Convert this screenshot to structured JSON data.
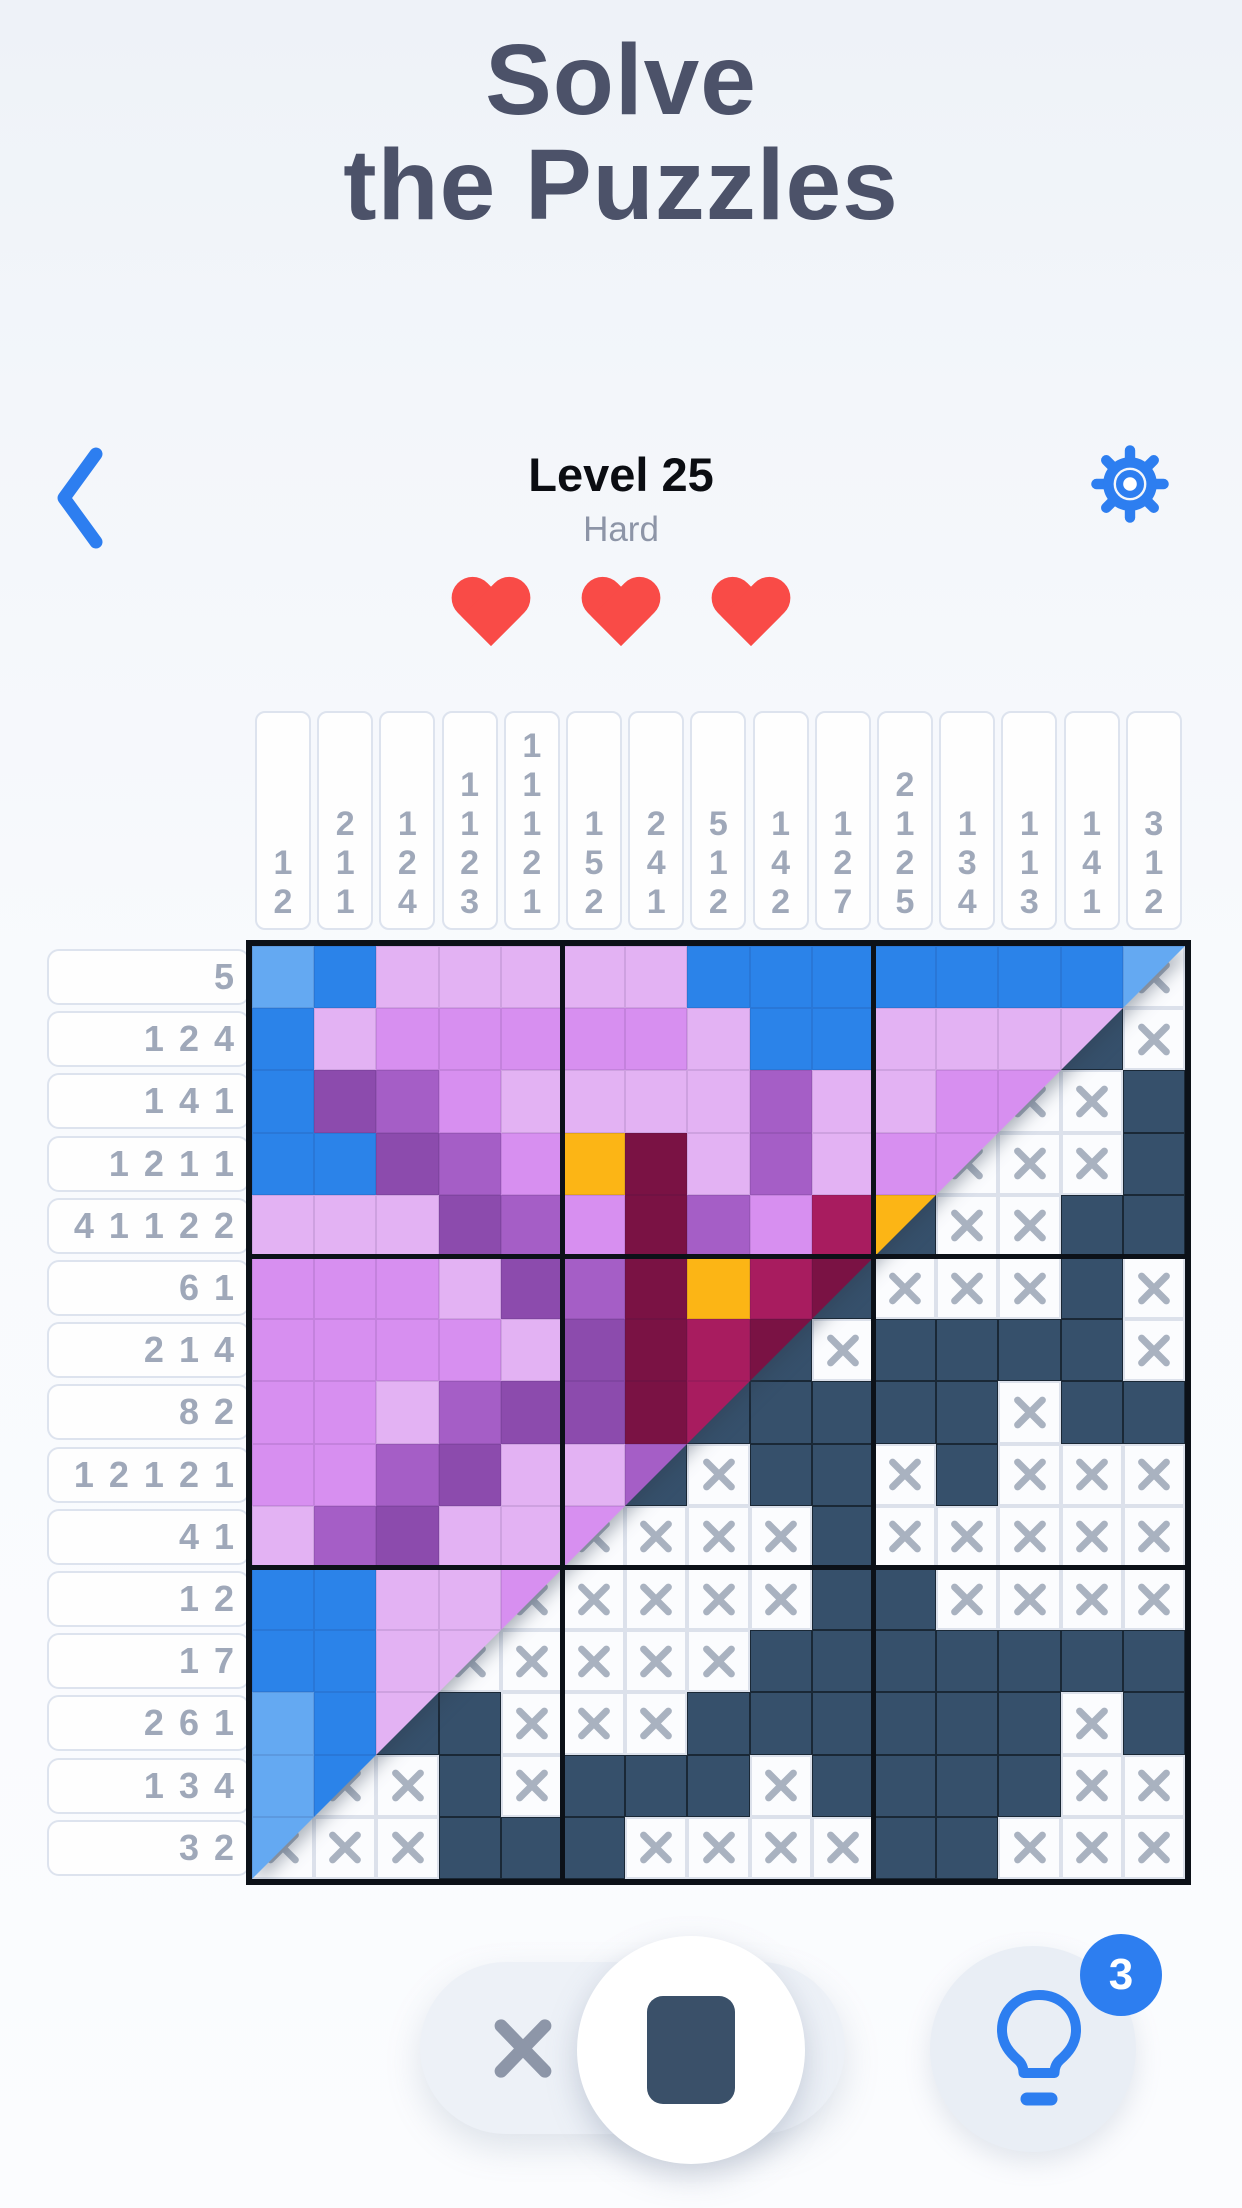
{
  "title_line1": "Solve",
  "title_line2": "the Puzzles",
  "header": {
    "level_label": "Level 25",
    "difficulty": "Hard",
    "hearts": 3
  },
  "toolbar": {
    "hint_count": "3"
  },
  "board": {
    "size": 15,
    "palette": {
      "LB": "#64a9f2",
      "B": "#2b83e9",
      "LP": "#e3b2f3",
      "P": "#d78ff0",
      "V": "#a55ec6",
      "DV": "#8c4bad",
      "O": "#fcb515",
      "DM": "#7a1244",
      "M": "#a81c5f",
      "fill": "#36506b",
      "xmark": "#a9b2c0",
      "accent_blue": "#2d7ef0",
      "heart_red": "#f94b47"
    },
    "col_clues": [
      [
        1,
        2
      ],
      [
        2,
        1,
        1
      ],
      [
        1,
        2,
        4
      ],
      [
        1,
        1,
        2,
        3
      ],
      [
        1,
        1,
        1,
        2,
        1
      ],
      [
        1,
        5,
        2
      ],
      [
        2,
        4,
        1
      ],
      [
        5,
        1,
        2
      ],
      [
        1,
        4,
        2
      ],
      [
        1,
        2,
        7
      ],
      [
        2,
        1,
        2,
        5
      ],
      [
        1,
        3,
        4
      ],
      [
        1,
        1,
        3
      ],
      [
        1,
        4,
        1
      ],
      [
        3,
        1,
        2
      ]
    ],
    "row_clues": [
      [
        5
      ],
      [
        1,
        2,
        4
      ],
      [
        1,
        4,
        1
      ],
      [
        1,
        2,
        1,
        1
      ],
      [
        4,
        1,
        1,
        2,
        2
      ],
      [
        6,
        1
      ],
      [
        2,
        1,
        4
      ],
      [
        8,
        2
      ],
      [
        1,
        2,
        1,
        2,
        1
      ],
      [
        4,
        1
      ],
      [
        1,
        2
      ],
      [
        1,
        7
      ],
      [
        2,
        6,
        1
      ],
      [
        1,
        3,
        4
      ],
      [
        3,
        2
      ]
    ],
    "puzzle": [
      "..............X",
      ".............PX",
      "............XXP",
      "...........XXXP",
      "..........PXXPP",
      ".........PXXXPX",
      "........PXPPPPX",
      ".......PPPPPXPP",
      "......PXPPXPXXX",
      ".....XXXXPXXXXX",
      "....XXXXXPPXXXX",
      "...XXXXXPPPPPPP",
      "..PPXXXPPPPPPXP",
      ".XXPXPPPXPPPPXX",
      "XXXPPPXXXXPPXXX"
    ],
    "image": [
      [
        "LB",
        "B",
        "LP",
        "LP",
        "LP",
        "LP",
        "LP",
        "B",
        "B",
        "B",
        "B",
        "B",
        "B",
        "B",
        "LB"
      ],
      [
        "B",
        "LP",
        "P",
        "P",
        "P",
        "P",
        "P",
        "LP",
        "B",
        "B",
        "LP",
        "LP",
        "LP",
        "LP",
        "LP"
      ],
      [
        "B",
        "DV",
        "V",
        "P",
        "LP",
        "LP",
        "LP",
        "LP",
        "V",
        "LP",
        "LP",
        "P",
        "P",
        "P",
        "P"
      ],
      [
        "B",
        "B",
        "DV",
        "V",
        "P",
        "O",
        "DM",
        "LP",
        "V",
        "LP",
        "P",
        "P",
        "P",
        "P",
        "P"
      ],
      [
        "LP",
        "LP",
        "LP",
        "DV",
        "V",
        "P",
        "DM",
        "V",
        "P",
        "M",
        "O",
        "O",
        "O",
        "O",
        "O"
      ],
      [
        "P",
        "P",
        "P",
        "LP",
        "DV",
        "V",
        "DM",
        "O",
        "M",
        "DM",
        "DM",
        "DM",
        "DM",
        "DM",
        "DM"
      ],
      [
        "P",
        "P",
        "P",
        "P",
        "LP",
        "DV",
        "DM",
        "M",
        "DM",
        "DM",
        "DM",
        "DM",
        "DM",
        "DM",
        "DM"
      ],
      [
        "P",
        "P",
        "LP",
        "V",
        "DV",
        "DV",
        "DM",
        "M",
        "M",
        "M",
        "M",
        "M",
        "M",
        "M",
        "M"
      ],
      [
        "P",
        "P",
        "V",
        "DV",
        "LP",
        "LP",
        "V",
        "V",
        "V",
        "V",
        "V",
        "V",
        "V",
        "V",
        "V"
      ],
      [
        "LP",
        "V",
        "DV",
        "LP",
        "LP",
        "P",
        "P",
        "P",
        "P",
        "P",
        "P",
        "P",
        "P",
        "P",
        "P"
      ],
      [
        "B",
        "B",
        "LP",
        "LP",
        "P",
        "P",
        "P",
        "P",
        "P",
        "P",
        "P",
        "P",
        "P",
        "P",
        "P"
      ],
      [
        "B",
        "B",
        "LP",
        "LP",
        "LP",
        "LP",
        "LP",
        "LP",
        "LP",
        "LP",
        "LP",
        "LP",
        "LP",
        "LP",
        "LP"
      ],
      [
        "LB",
        "B",
        "LP",
        "LP",
        "LP",
        "LP",
        "LP",
        "LP",
        "LP",
        "LP",
        "LP",
        "LP",
        "LP",
        "LP",
        "LP"
      ],
      [
        "LB",
        "B",
        "B",
        "B",
        "B",
        "B",
        "B",
        "B",
        "B",
        "B",
        "B",
        "B",
        "B",
        "B",
        "B"
      ],
      [
        "LB",
        "LB",
        "LB",
        "LB",
        "LB",
        "LB",
        "LB",
        "LB",
        "LB",
        "LB",
        "LB",
        "LB",
        "LB",
        "LB",
        "LB"
      ]
    ]
  }
}
